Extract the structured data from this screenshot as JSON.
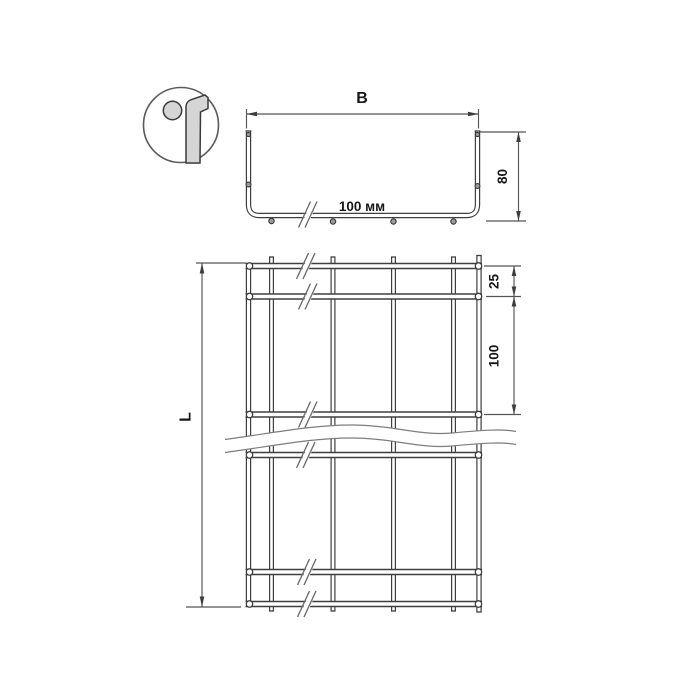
{
  "drawing": {
    "type": "wire-mesh-cable-tray-technical-drawing",
    "labels": {
      "width": "B",
      "height": "80",
      "mesh_note": "100 мм",
      "length": "L",
      "end_offset": "25",
      "pitch": "100"
    },
    "colors": {
      "line": "#3f3f3f",
      "dimension": "#555555",
      "text": "#161616",
      "steel_fill": "#d5d5d5",
      "background": "#ffffff"
    }
  }
}
